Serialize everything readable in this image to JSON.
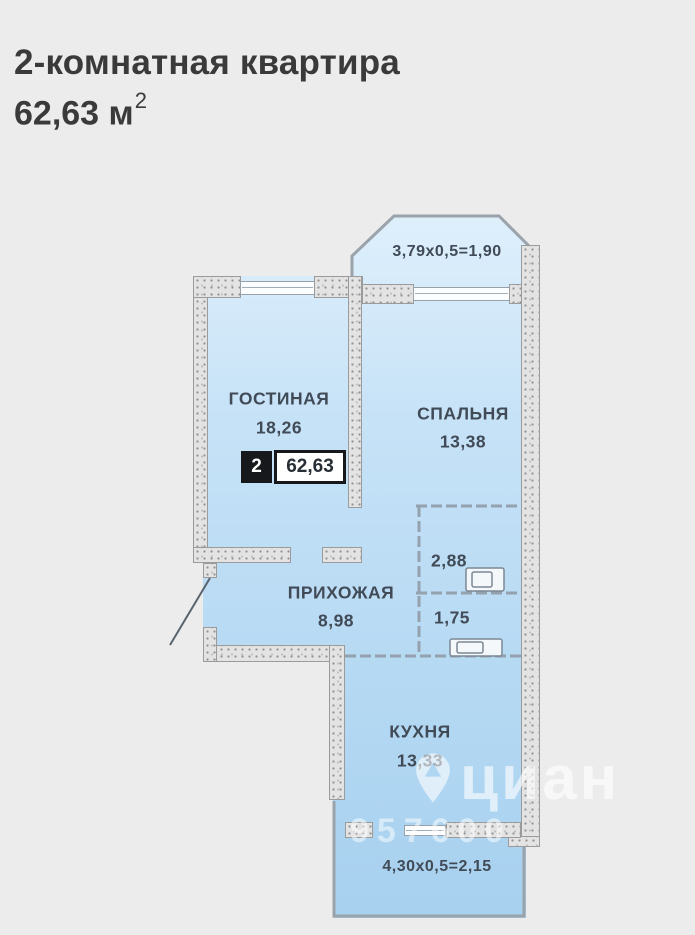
{
  "header": {
    "title": "2-комнатная квартира",
    "area_value": "62,63 м",
    "area_sup": "2"
  },
  "plan": {
    "colors": {
      "room_fill_top": "#e0f0fc",
      "room_fill_bottom": "#a7d1ef",
      "wall_fill": "#e3e3e3",
      "outline": "#9aa2aa",
      "label_text": "#414b57",
      "badge_bg": "#16181b"
    },
    "balcony_top": {
      "dim": "3,79x0,5=1,90"
    },
    "balcony_bottom": {
      "dim": "4,30x0,5=2,15"
    },
    "rooms": [
      {
        "id": "living",
        "name": "ГОСТИНАЯ",
        "area": "18,26"
      },
      {
        "id": "bedroom",
        "name": "СПАЛЬНЯ",
        "area": "13,38"
      },
      {
        "id": "hall",
        "name": "ПРИХОЖАЯ",
        "area": "8,98"
      },
      {
        "id": "bath",
        "name": "",
        "area": "2,88"
      },
      {
        "id": "wc",
        "name": "",
        "area": "1,75"
      },
      {
        "id": "kitchen",
        "name": "КУХНЯ",
        "area": "13,33"
      }
    ],
    "badge": {
      "rooms": "2",
      "total_area": "62,63"
    }
  },
  "watermark": {
    "brand": "циан",
    "phone": "957600"
  }
}
